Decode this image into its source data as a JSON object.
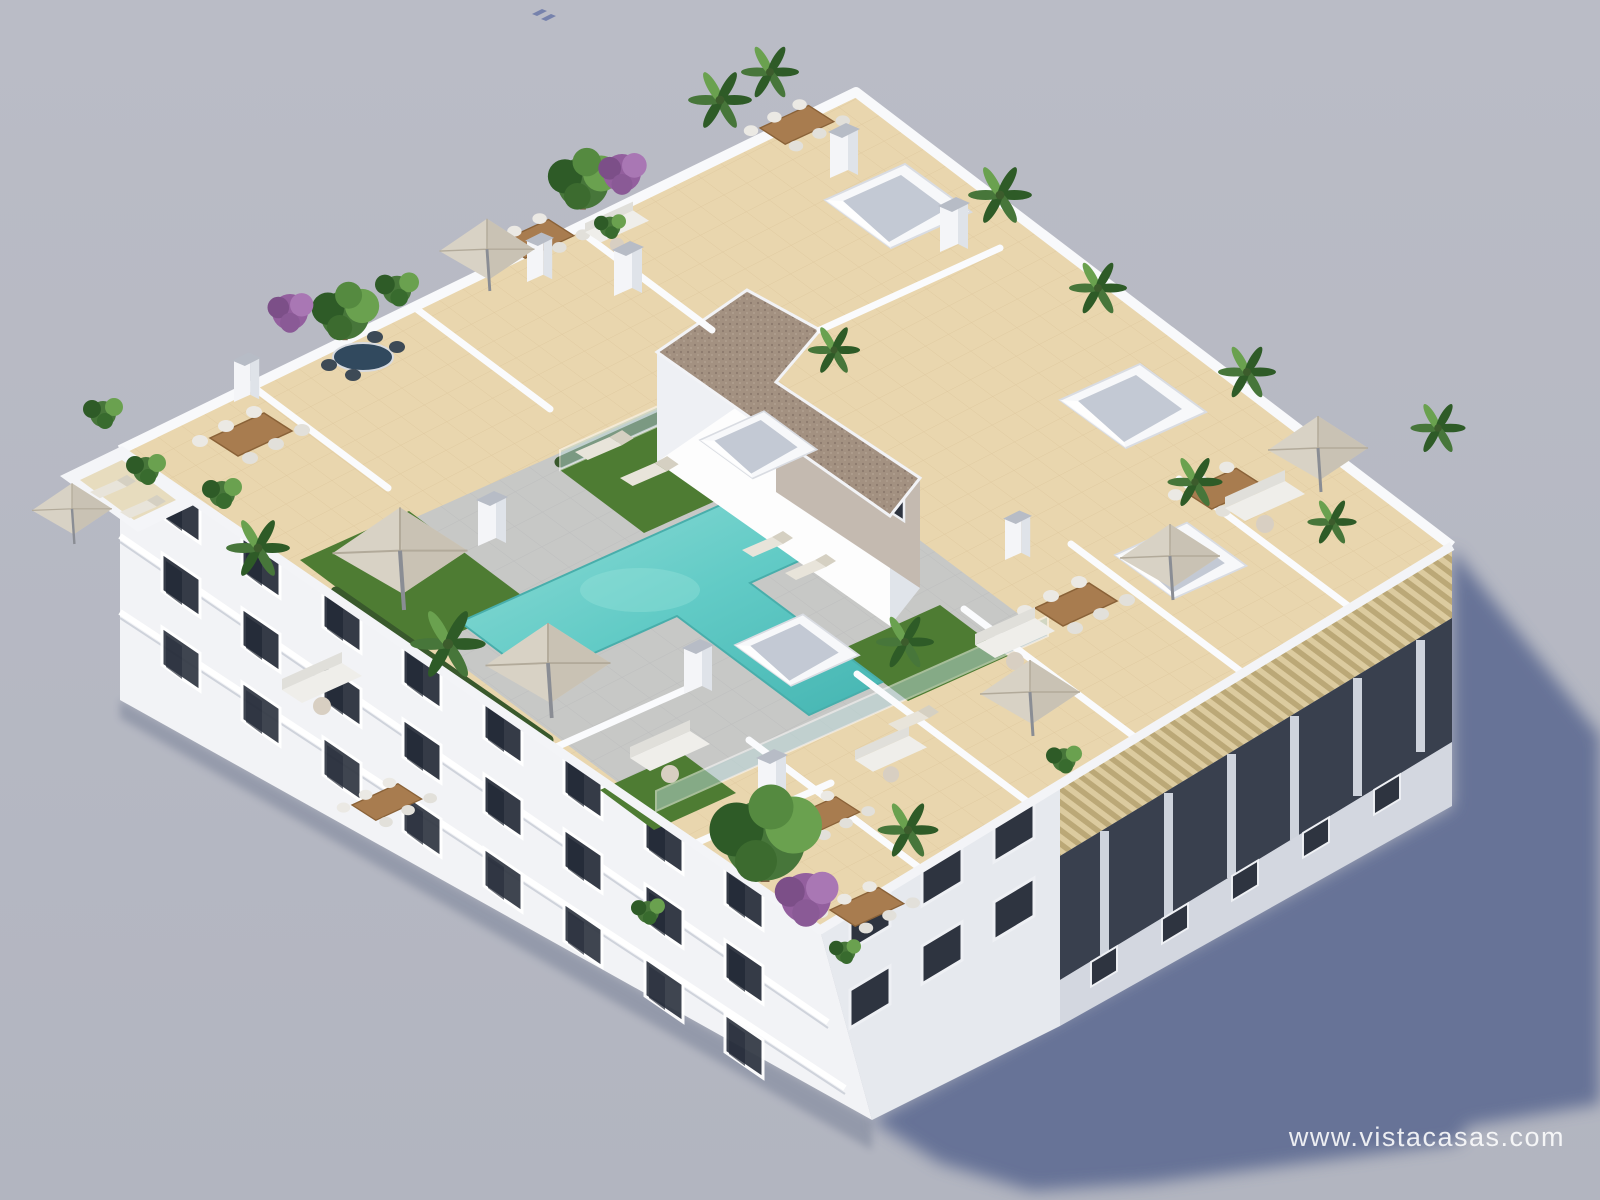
{
  "watermark": {
    "text": "www.vistacasas.com",
    "color": "#ffffff"
  },
  "scene": {
    "type": "3d-architectural-render",
    "subject": "aerial view of apartment building rooftop with communal pool and private terraces",
    "colors": {
      "background": "#b7b9c3",
      "background_low": "#b2b5c0",
      "shadow": "#5e6c93",
      "building_white": "#f2f3f6",
      "roof_tile": "#e9d6ae",
      "paving": "#c7c8c6",
      "pool": "#54c3bf",
      "pool_light": "#8fdcd6",
      "turf": "#4e7c33",
      "gravel": "#a39181",
      "wood": "#a87c4f",
      "umbrella": "#d8d2c5",
      "foliage_dark": "#2e5b27",
      "foliage": "#47763a",
      "foliage_light": "#6aa14f",
      "purple": "#935f9e",
      "glass": "#bcd9d8",
      "window_dark": "#353b47",
      "pergola": "#cfc09a",
      "watermark_color": "#ffffff"
    }
  }
}
